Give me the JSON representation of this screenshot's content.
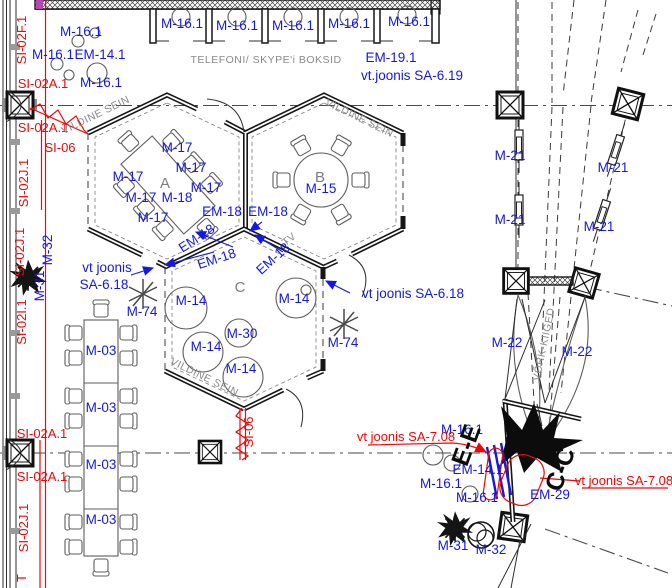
{
  "drawing_type": "architectural floor plan (CAD)",
  "colors": {
    "blue": "#1418e0",
    "red": "#ee0808",
    "gray": "#8a8a8a",
    "wall": "#161616"
  },
  "rooms": {
    "a": "A",
    "b": "B",
    "c": "C"
  },
  "gray": {
    "booths": "TELEFONI/ SKYPE'i BOKSID",
    "vildine": "VILDINE SEIN",
    "vork": "VÕRK-KIIGED",
    "tv": "TV"
  },
  "labels": {
    "m16": "M-16.1",
    "em14": "EM-14.1",
    "em19": "EM-19.1",
    "sa619": "vt.joonis SA-6.19",
    "m17": "M-17",
    "m18": "M-18",
    "em18": "EM-18",
    "m15": "M-15",
    "m14": "M-14",
    "m30": "M-30",
    "m74": "M-74",
    "m03": "M-03",
    "m21": "M-21",
    "m22": "M-22",
    "m31": "M-31",
    "m32": "M-32",
    "em29": "EM-29",
    "vt_joonis": "vt joonis",
    "sa618": "SA-6.18",
    "vt_sa618": "vt joonis SA-6.18"
  },
  "red_labels": {
    "si02f1": "SI-02F.1",
    "si02a1": "SI-02A.1",
    "si06": "SI-06",
    "si02j1": "SI-02J.1",
    "si02i1": "SI-02I.1",
    "vt_sa708": "vt joonis SA-7.08",
    "partial_t": "T"
  },
  "sections": {
    "ee": "E-E",
    "cc": "C-C"
  }
}
